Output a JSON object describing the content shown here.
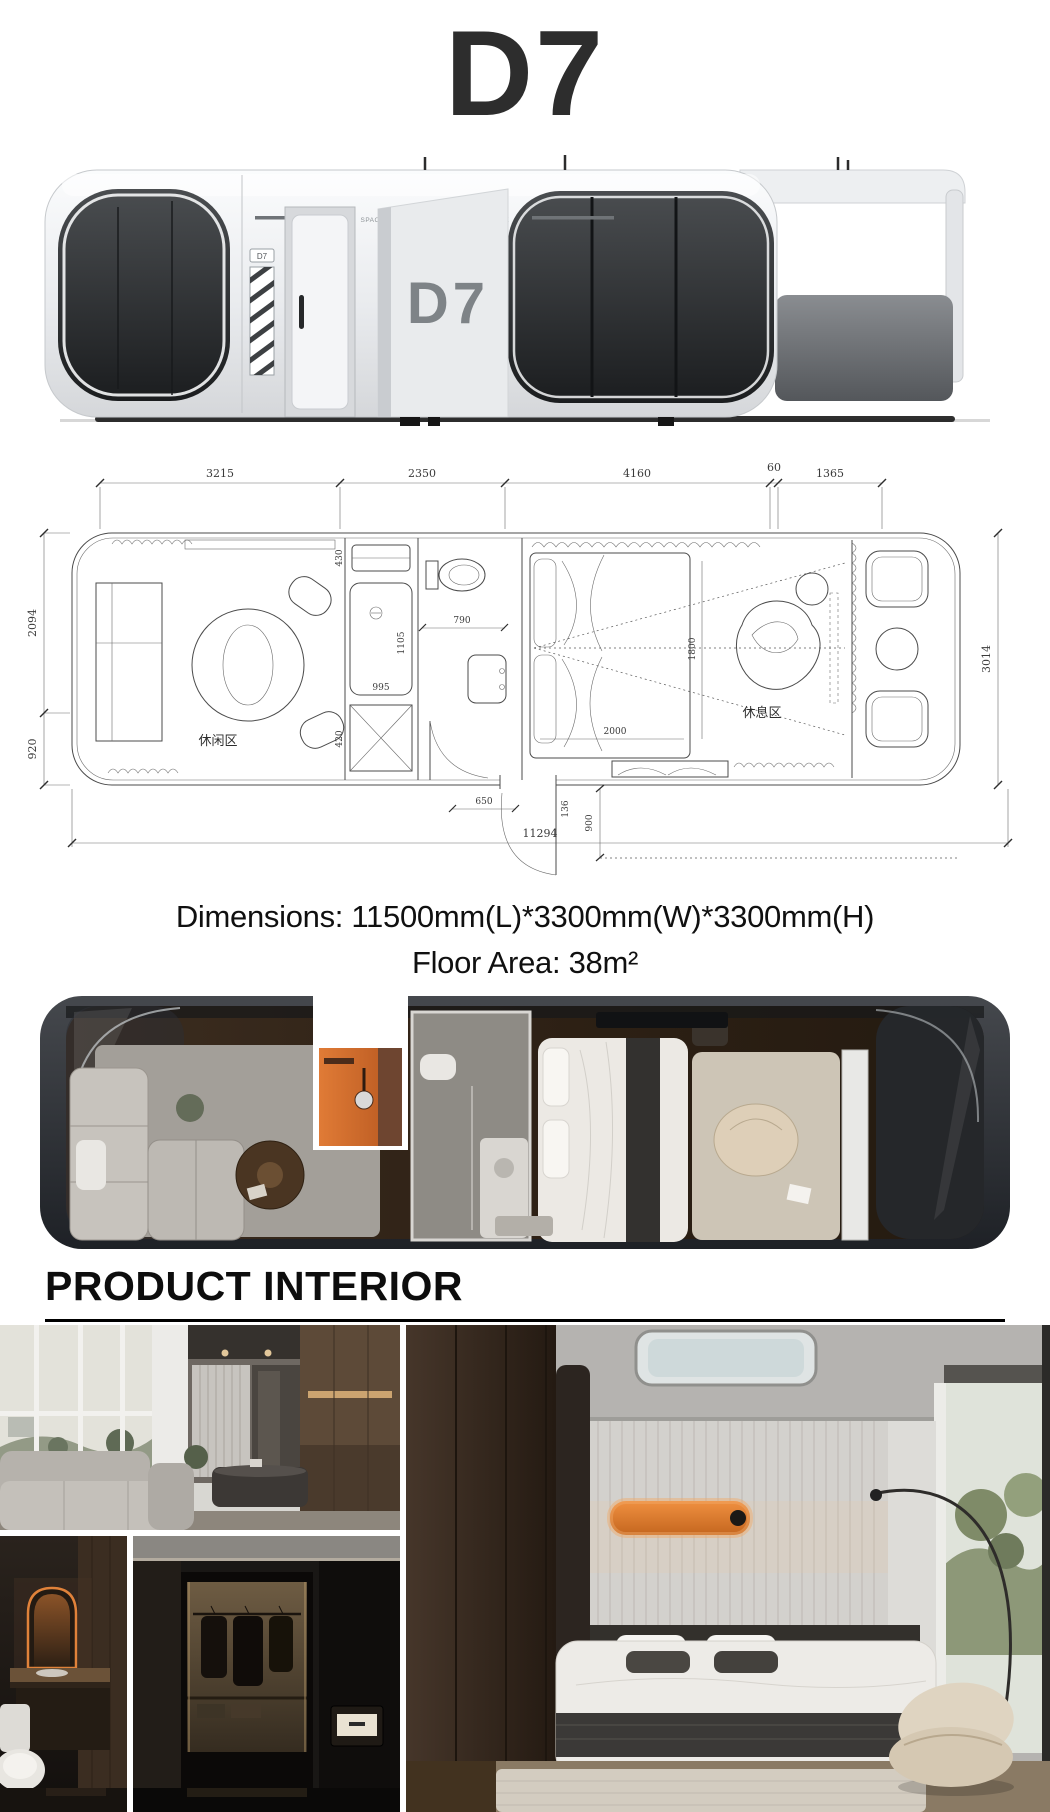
{
  "page": {
    "title": "D7"
  },
  "exterior": {
    "brand_text": "SPACE CABIN ACCOMMODATION MODULE",
    "logo_text": "D7",
    "panel_label": "D7"
  },
  "floorplan": {
    "dims_top": [
      "3215",
      "2350",
      "4160",
      "60",
      "1365"
    ],
    "dims_left": [
      "2094",
      "920"
    ],
    "dim_right": "3014",
    "dim_bottom": "11294",
    "dims_inner": {
      "washer": "430",
      "shower_l": "1105",
      "shower_w": "995",
      "bath": "790",
      "entry": "650",
      "bed_l": "2000",
      "bed_w": "1800",
      "door": "900",
      "cabinet": "420",
      "step": "136"
    },
    "labels": {
      "leisure": "休闲区",
      "rest": "休息区"
    }
  },
  "specs": {
    "dimensions": "Dimensions: 11500mm(L)*3300mm(W)*3300mm(H)",
    "floor_area": "Floor Area: 38m²"
  },
  "sections": {
    "interior_heading": "PRODUCT INTERIOR"
  },
  "colors": {
    "accent_orange": "#d9732f",
    "ink": "#2d2d2d"
  }
}
